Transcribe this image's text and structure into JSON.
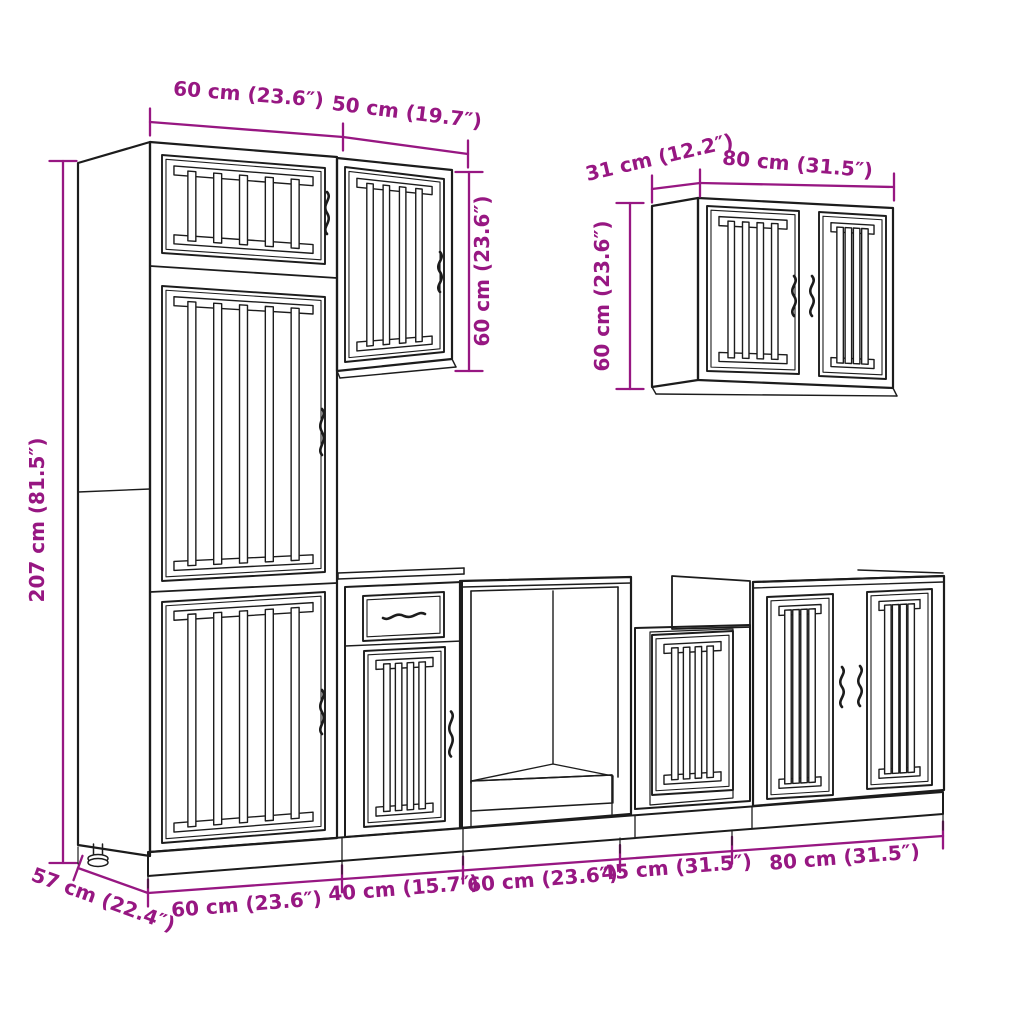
{
  "diagram": {
    "description": "kitchen cabinet set line drawing with dimension annotations",
    "style": {
      "dimension_color": "#971782",
      "line_color": "#1c1c1c",
      "background": "#ffffff"
    },
    "labels": {
      "tall_width": "60 cm (23.6″)",
      "upper50_width": "50 cm (19.7″)",
      "upper50_height": "60 cm (23.6″)",
      "wall_depth": "31 cm (12.2″)",
      "wall_width": "80 cm (31.5″)",
      "wall_height": "60 cm (23.6″)",
      "total_height": "207 cm (81.5″)",
      "base_depth": "57 cm (22.4″)",
      "base_w1": "60 cm (23.6″)",
      "base_w2": "40 cm (15.7″)",
      "base_w3": "60 cm (23.6″)",
      "base_w4": "45 cm (31.5″)",
      "base_w5": "80 cm (31.5″)"
    }
  }
}
